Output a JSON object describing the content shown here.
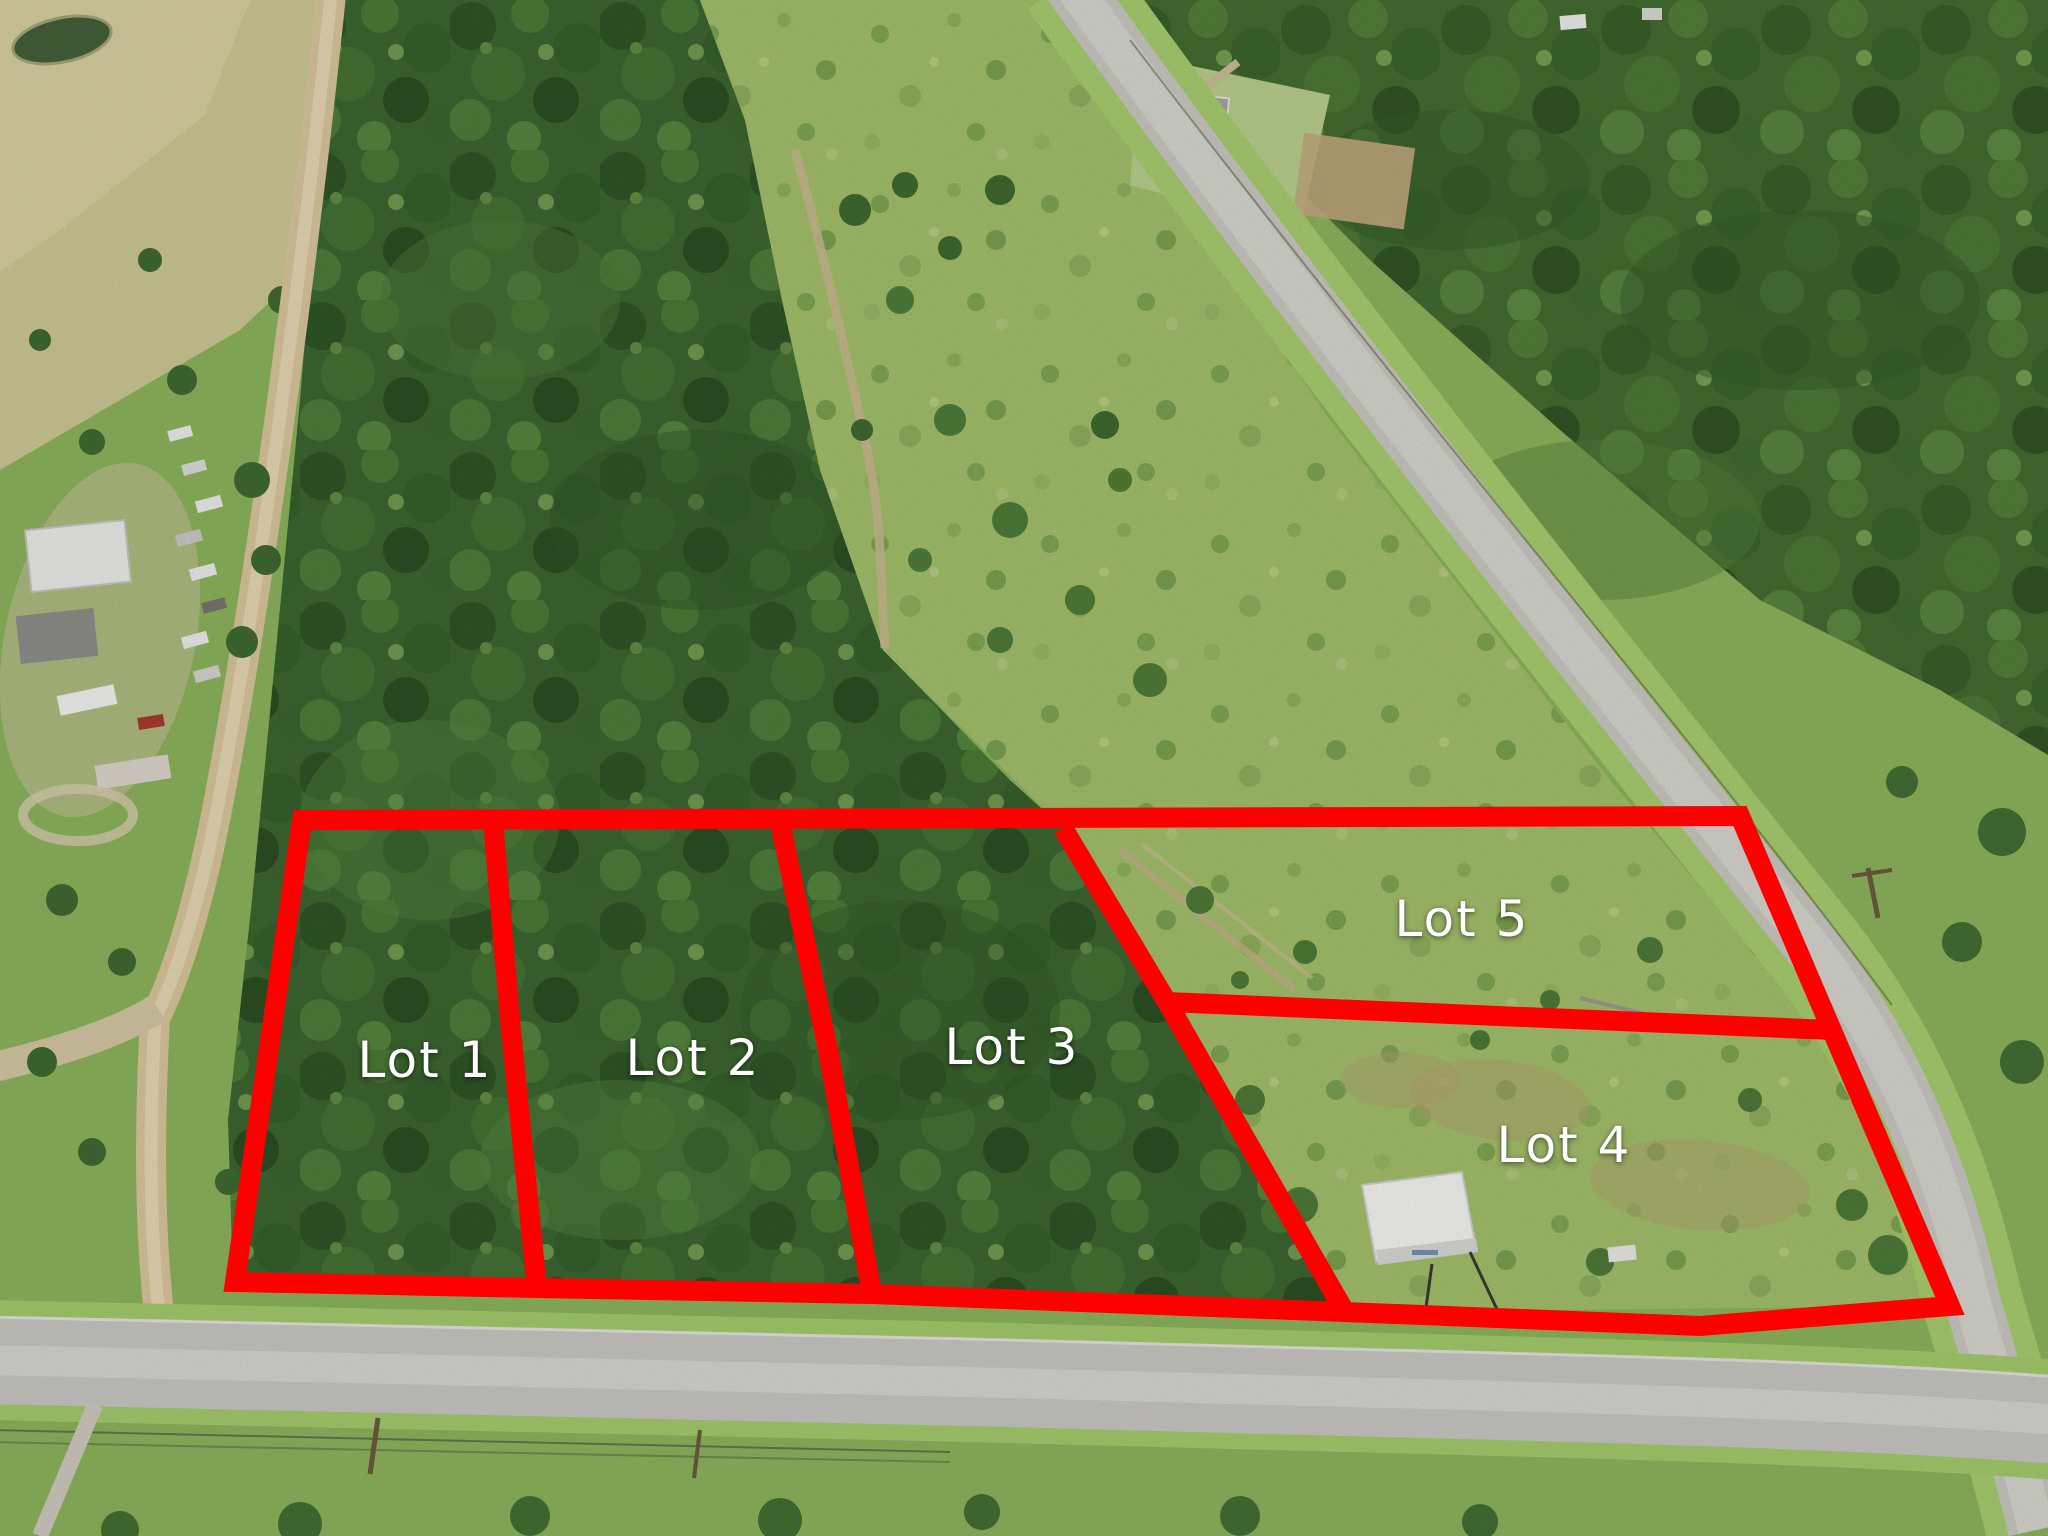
{
  "photo": {
    "type": "drone-aerial-photo",
    "scene": "Rural acreage subdivided into five numbered lots outlined in red; wooded terrain and pasture, dirt road on the left, paved county roads along the right side and bottom, farmstead with vehicles at left, white storage building inside Lot 4",
    "accent_color": "#ff0000",
    "label_color": "#ffffff"
  },
  "lots": [
    {
      "label": "Lot 1"
    },
    {
      "label": "Lot 2"
    },
    {
      "label": "Lot 3"
    },
    {
      "label": "Lot 4"
    },
    {
      "label": "Lot 5"
    }
  ],
  "overlay": {
    "color": "#ff0000",
    "stroke_width": 20,
    "shapes": [
      {
        "name": "tract-outline",
        "closed": true,
        "points": "302,820 1740,816 1950,1306 1700,1326 1345,1312 872,1294 537,1288 235,1282"
      },
      {
        "name": "divider-lot1-lot2",
        "closed": false,
        "points": "493,821 510,1020 537,1288"
      },
      {
        "name": "divider-lot2-lot3",
        "closed": false,
        "points": "780,822 828,1050 872,1294"
      },
      {
        "name": "divider-lot3-lot4",
        "closed": false,
        "points": "1063,828 1167,1002 1345,1312"
      },
      {
        "name": "divider-lot4-lot5",
        "closed": false,
        "points": "1167,1002 1832,1030"
      }
    ]
  }
}
